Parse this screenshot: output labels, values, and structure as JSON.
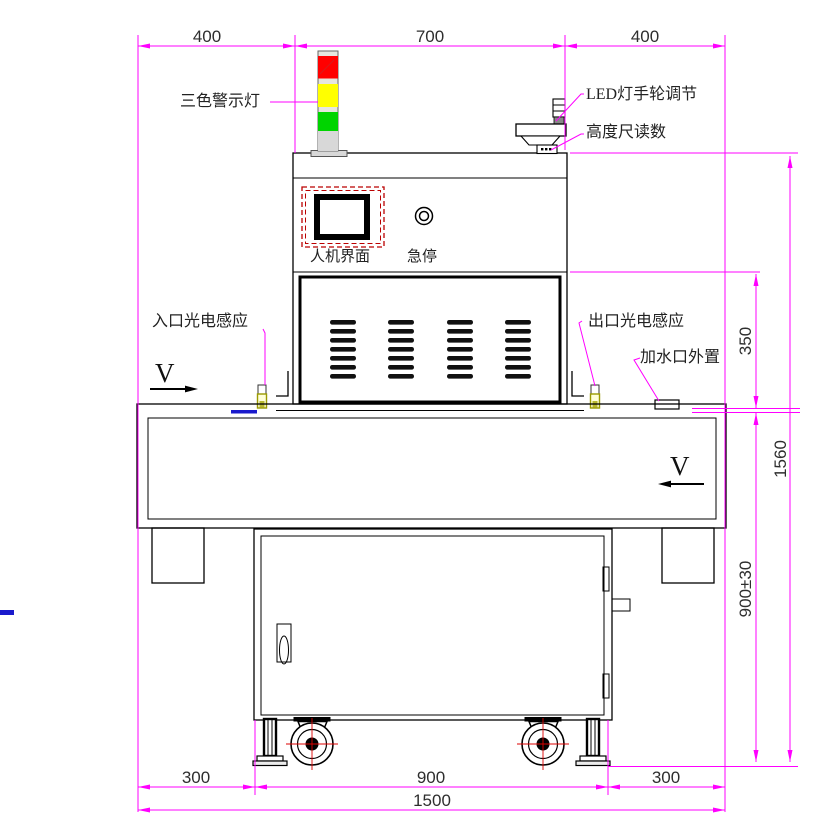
{
  "colors": {
    "dimension_line": "#FF00FF",
    "outline": "#000000",
    "light_red": "#FF0000",
    "light_yellow": "#FFFF00",
    "light_green": "#00D400",
    "tower_gray": "#D8D8D8",
    "hmi_dash_red": "#BB0000",
    "sensor_olive": "#9A9A00",
    "sensor_fill": "#FFFFD8",
    "caster_crosshair": "#DD0000",
    "blue_mark": "#1A1ACC"
  },
  "dimensions": {
    "top_left": "400",
    "top_center": "700",
    "top_right": "400",
    "right_upper": "350",
    "right_total": "1560",
    "right_lower": "900±30",
    "bottom_left": "300",
    "bottom_center": "900",
    "bottom_right": "300",
    "bottom_total": "1500"
  },
  "callouts": {
    "warning_light": "三色警示灯",
    "led_handwheel": "LED灯手轮调节",
    "height_gauge": "高度尺读数",
    "hmi_panel": "人机界面",
    "emergency_stop": "急停",
    "inlet_sensor": "入口光电感应",
    "outlet_sensor": "出口光电感应",
    "water_port": "加水口外置"
  },
  "flow": {
    "left_arrow": "V",
    "right_arrow": "V"
  }
}
